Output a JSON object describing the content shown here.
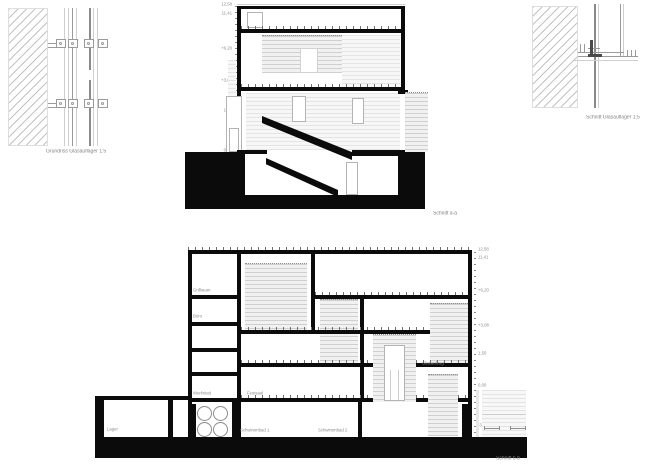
{
  "sheet": {
    "background": "#ffffff",
    "ink_color": "#0b0b0b",
    "hatch_color": "#c3c3c3",
    "label_color": "#8d8d8d"
  },
  "plan_detail": {
    "caption": "Grundriss Glasauflager 1:5"
  },
  "section_detail": {
    "caption": "Schnitt Glasauflager 1:5"
  },
  "section_a": {
    "caption": "Schnitt a-a",
    "levels": [
      "12,58",
      "11,41",
      "+6,20",
      "+3,08",
      "1,50",
      "0,00",
      "-4,20"
    ]
  },
  "section_b": {
    "caption": "Schnitt b-b",
    "levels": [
      "12,58",
      "11,41",
      "+6,20",
      "+3,08",
      "1,50",
      "0,00",
      "-3,05"
    ],
    "rooms": {
      "grillraum": "Grillraum",
      "buero": "Büro",
      "werkstatt": "Werkstatt",
      "festsaal": "Festsaal",
      "glasaufzug": "Glasaufzug",
      "lager": "Lager",
      "schwimmbad1": "Schwimmbad 1",
      "schwimmbad2": "Schwimmbad 2"
    }
  }
}
